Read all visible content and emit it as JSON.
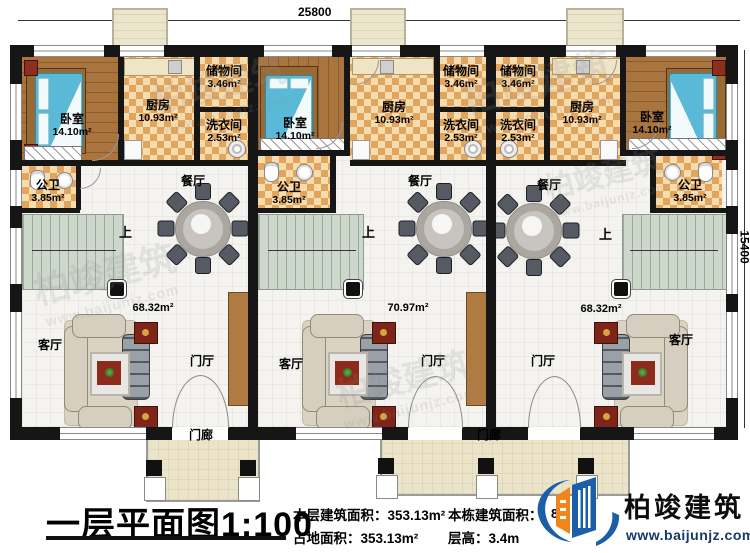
{
  "meta": {
    "title": "一层平面图1:100"
  },
  "dimensions": {
    "width": "25800",
    "height": "15400"
  },
  "rooms": {
    "bedroom": {
      "name": "卧室",
      "area": "14.10m²"
    },
    "kitchen": {
      "name": "厨房",
      "area": "10.93m²"
    },
    "storage": {
      "name": "储物间",
      "area": "3.46m²"
    },
    "laundry": {
      "name": "洗衣间",
      "area": "2.53m²"
    },
    "bath": {
      "name": "公卫",
      "area": "3.85m²"
    },
    "dining": {
      "name": "餐厅"
    },
    "living": {
      "name": "客厅"
    },
    "foyer": {
      "name": "门厅"
    },
    "porch": {
      "name": "门廊"
    },
    "up": "上"
  },
  "unit_areas": {
    "left": "68.32m²",
    "middle": "70.97m²",
    "right": "68.32m²"
  },
  "stats": {
    "floor_area_label": "本层建筑面积：",
    "floor_area_value": "353.13m²",
    "land_area_label": "占地面积：",
    "land_area_value": "353.13m²",
    "building_area_label": "本栋建筑面积：",
    "building_area_obscured": "8",
    "floor_height_label": "层高：",
    "floor_height_value": "3.4m"
  },
  "brand": {
    "name": "柏竣建筑",
    "url": "www.baijunjz.com",
    "blue": "#1b5fa8",
    "orange": "#f08519"
  },
  "watermark": {
    "name": "柏竣建筑",
    "url": "www.baijunjz.com"
  }
}
